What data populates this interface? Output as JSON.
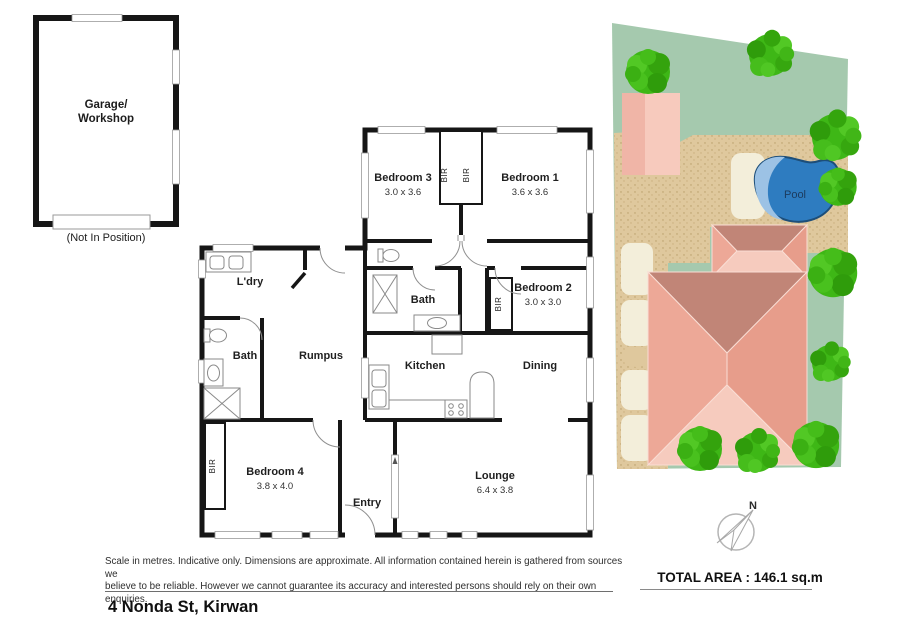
{
  "garage": {
    "line1": "Garage/",
    "line2": "Workshop",
    "note": "(Not In Position)"
  },
  "rooms": {
    "bedroom3": {
      "name": "Bedroom 3",
      "dims": "3.0 x 3.6"
    },
    "bedroom1": {
      "name": "Bedroom 1",
      "dims": "3.6 x 3.6"
    },
    "bedroom2": {
      "name": "Bedroom 2",
      "dims": "3.0 x 3.0"
    },
    "bedroom4": {
      "name": "Bedroom 4",
      "dims": "3.8 x 4.0"
    },
    "lounge": {
      "name": "Lounge",
      "dims": "6.4 x 3.8"
    },
    "kitchen": {
      "name": "Kitchen"
    },
    "dining": {
      "name": "Dining"
    },
    "rumpus": {
      "name": "Rumpus"
    },
    "bath_main": {
      "name": "Bath"
    },
    "bath_two": {
      "name": "Bath"
    },
    "laundry": {
      "name": "L'dry"
    },
    "entry": {
      "name": "Entry"
    }
  },
  "closets": {
    "bir_label": "BIR"
  },
  "site_plan": {
    "pool_label": "Pool"
  },
  "compass": {
    "north": "N"
  },
  "footer": {
    "disclaimer_line1": "Scale in metres. Indicative only. Dimensions are approximate. All information contained herein is gathered from sources we",
    "disclaimer_line2": "believe to be reliable. However we cannot guarantee its accuracy and interested persons should rely on their own enquiries.",
    "total_area": "TOTAL AREA : 146.1 sq.m",
    "address": "4 Nonda St, Kirwan"
  },
  "colors": {
    "wall": "#161616",
    "lawn": "#a5c9ae",
    "sand": "#dfc89d",
    "sand_dot": "#b89c68",
    "stone": "#f3eeda",
    "building_pink": "#f0b5a7",
    "building_pink_light": "#f7cabd",
    "roof_dark": "#c18577",
    "roof_mid_left": "#eda897",
    "roof_mid_right": "#e79d8b",
    "roof_light": "#f6cbbe",
    "pool_fill": "#2e7cc0",
    "pool_light": "#9cc2e5",
    "pool_outline": "#1d4e79",
    "tree_green": "#3eb716",
    "tree_green_dark": "#2f9c0b",
    "tree_green_light": "#52c825",
    "compass_gray": "#b5b5b5"
  }
}
